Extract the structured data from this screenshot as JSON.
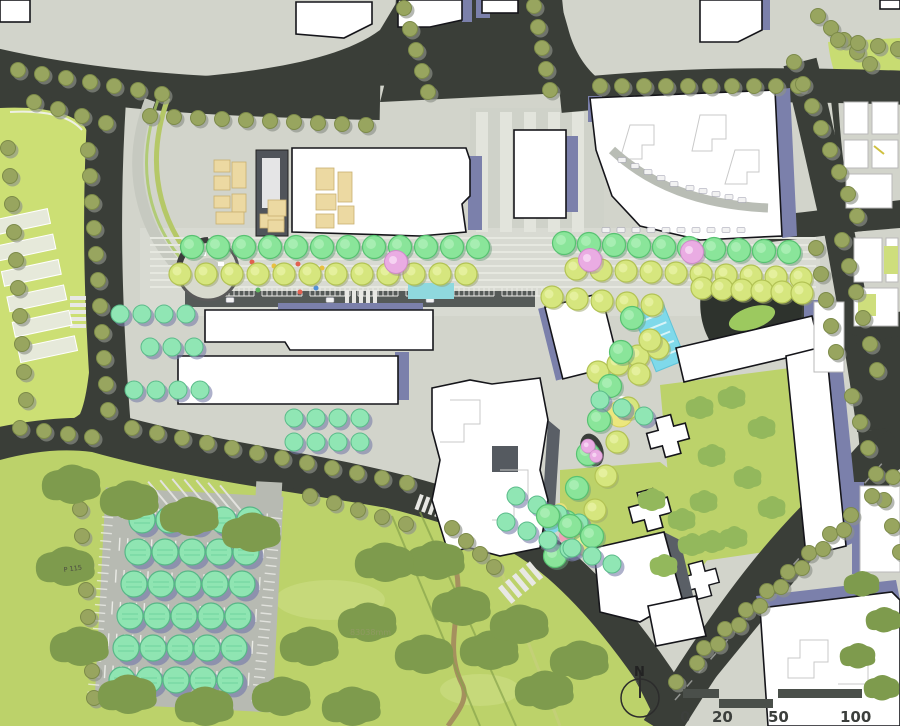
{
  "plan": {
    "annotations": {
      "area_label": "83038mm",
      "parking_label": "P 115"
    },
    "compass": {
      "label": "N"
    },
    "scale_bar": {
      "ticks": [
        "0",
        "20",
        "50",
        "100"
      ]
    },
    "palette": {
      "road": "#3a3e38",
      "paving": "#d2d4cb",
      "lawn": "#bcd26a",
      "field": "#ccdf74",
      "building": "#ffffff",
      "building_outline": "#15151a",
      "shadow_purple": "#7b80ab",
      "tree_olive": "#98a55f",
      "tree_green": "#8ae59a",
      "tree_lime": "#d6e67e",
      "tree_mint": "#90e6b4",
      "tree_pink": "#eaace3",
      "park_canopy": "#7e9b4d",
      "water": "#7fd9ea",
      "kiosk_tan": "#ecd9a2",
      "plaza_dark": "#2e332d"
    }
  }
}
